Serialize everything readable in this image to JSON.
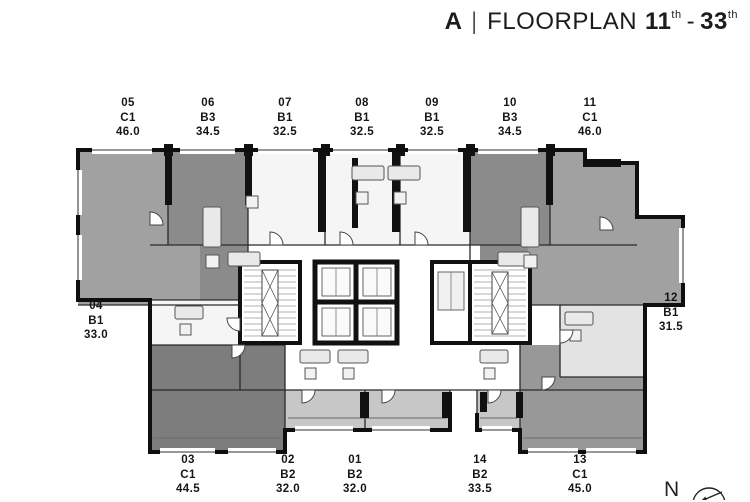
{
  "title": {
    "building": "A",
    "separator": "|",
    "label": "FLOORPLAN",
    "range_start": "11",
    "range_start_sup": "th",
    "range_dash": "-",
    "range_end": "33",
    "range_end_sup": "th"
  },
  "plan": {
    "units": [
      {
        "id": "05",
        "type": "C1",
        "area": "46.0",
        "side": "top"
      },
      {
        "id": "06",
        "type": "B3",
        "area": "34.5",
        "side": "top"
      },
      {
        "id": "07",
        "type": "B1",
        "area": "32.5",
        "side": "top"
      },
      {
        "id": "08",
        "type": "B1",
        "area": "32.5",
        "side": "top"
      },
      {
        "id": "09",
        "type": "B1",
        "area": "32.5",
        "side": "top"
      },
      {
        "id": "10",
        "type": "B3",
        "area": "34.5",
        "side": "top"
      },
      {
        "id": "11",
        "type": "C1",
        "area": "46.0",
        "side": "top"
      },
      {
        "id": "04",
        "type": "B1",
        "area": "33.0",
        "side": "left"
      },
      {
        "id": "12",
        "type": "B1",
        "area": "31.5",
        "side": "right"
      },
      {
        "id": "03",
        "type": "C1",
        "area": "44.5",
        "side": "bottom"
      },
      {
        "id": "02",
        "type": "B2",
        "area": "32.0",
        "side": "bottom"
      },
      {
        "id": "01",
        "type": "B2",
        "area": "32.0",
        "side": "bottom"
      },
      {
        "id": "14",
        "type": "B2",
        "area": "33.5",
        "side": "bottom"
      },
      {
        "id": "13",
        "type": "C1",
        "area": "45.0",
        "side": "bottom"
      }
    ]
  },
  "compass": {
    "north_label": "N"
  },
  "colors": {
    "wall": "#111111",
    "unit_medium_gray": "#a1a1a1",
    "unit_dark_gray": "#8b8b8b",
    "unit_deep_gray": "#7d7d7d",
    "unit_mid2_gray": "#989898",
    "unit_light_gray": "#c7c7c7",
    "unit_pale_gray": "#e3e3e3",
    "unit_white": "#f5f5f5",
    "text": "#161616"
  }
}
